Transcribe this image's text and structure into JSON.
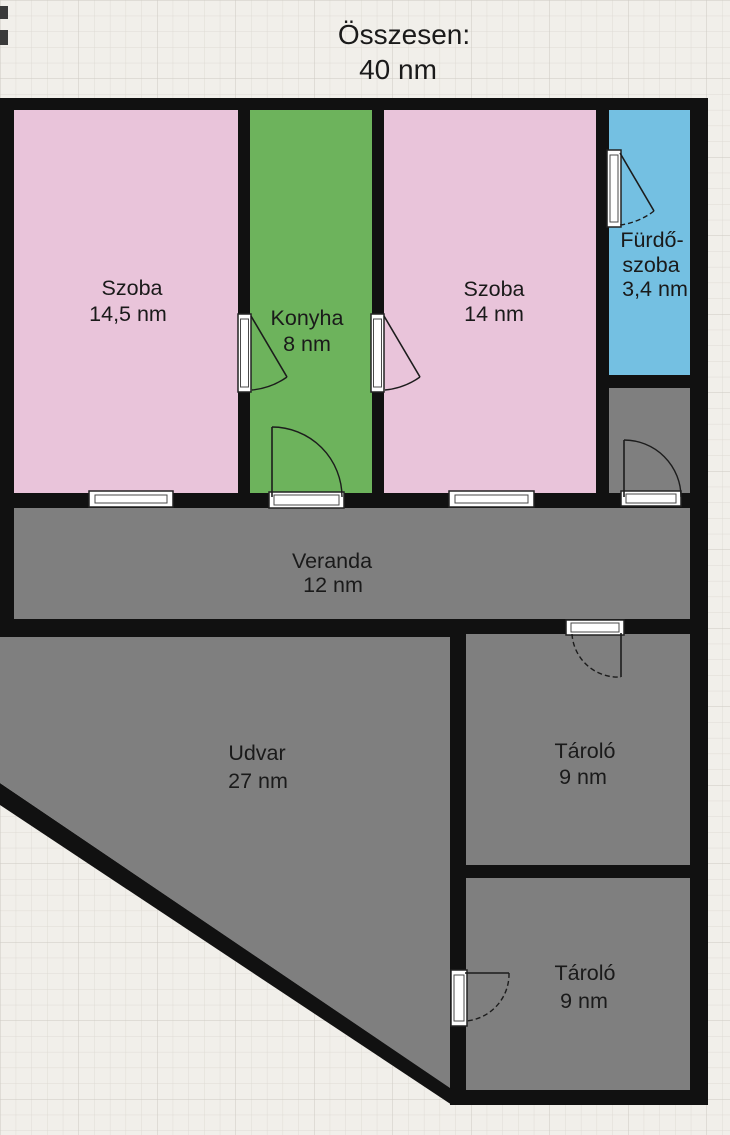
{
  "title": {
    "line1": "Összesen:",
    "line2": "40 nm"
  },
  "rooms": [
    {
      "name": "Szoba",
      "area": "14,5 nm"
    },
    {
      "name": "Konyha",
      "area": "8 nm"
    },
    {
      "name": "Szoba",
      "area": "14 nm"
    },
    {
      "name": "Fürdő-",
      "name2": "szoba",
      "area": "3,4 nm"
    },
    {
      "name": "Veranda",
      "area": "12 nm"
    },
    {
      "name": "Udvar",
      "area": "27 nm"
    },
    {
      "name": "Tároló",
      "area": "9 nm"
    },
    {
      "name": "Tároló",
      "area": "9 nm"
    }
  ],
  "colors": {
    "room_pink": "#e9c4da",
    "room_green": "#6db35c",
    "room_blue": "#74c0e2",
    "room_gray": "#7f7f7f",
    "wall": "#111111",
    "paper": "#f1efea"
  }
}
